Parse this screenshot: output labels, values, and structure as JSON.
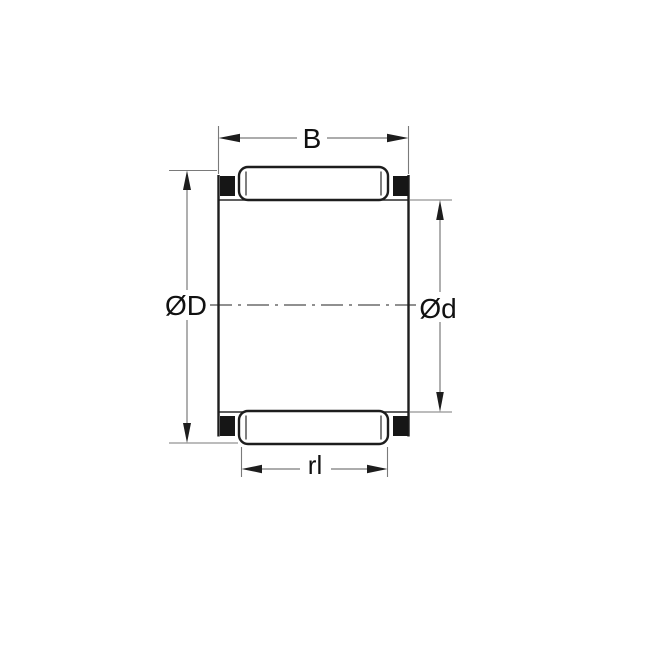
{
  "drawing": {
    "description": "Needle roller and cage assembly cross-section drawing",
    "labels": {
      "width": "B",
      "outer_diameter": "ØD",
      "bore_diameter": "Ød",
      "roller_length": "rl"
    },
    "colors": {
      "background": "#ffffff",
      "outline": "#1d1d1d",
      "dimension_lines": "#7a7a7a",
      "centerline": "#6b6b6b",
      "cage_ring_fill": "#161616",
      "label_text": "#111111"
    }
  }
}
